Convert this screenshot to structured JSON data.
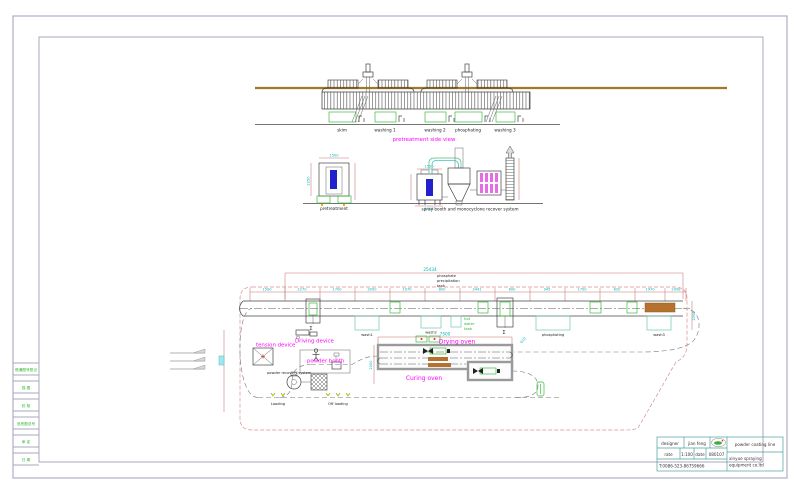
{
  "margin_strip": {
    "items": [
      "借通图号登记",
      "描 图",
      "校 核",
      "旧底图总号",
      "审 定",
      "日 期"
    ]
  },
  "side_view": {
    "caption": "pretreatment side view",
    "tank_labels": [
      "skim",
      "washing 1",
      "washing 2",
      "phosphating",
      "washing 3"
    ]
  },
  "elevation": {
    "left_caption": "pretreatment",
    "right_caption": "spray booth and monocyclone recover system",
    "dim_left_v": "2250",
    "dim_left_h": "1500",
    "dim_booth_h": "1500",
    "dim_booth_base": "1008"
  },
  "plan": {
    "overall_dim": "25434",
    "oven_dim": "7500",
    "right_dim": "2008",
    "slant_dim": "610",
    "oven_side_dim": "2000",
    "segment_dims": [
      "1500",
      "2270",
      "1700",
      "3000",
      "1970",
      "800",
      "3441",
      "600",
      "945",
      "1700",
      "620",
      "1970",
      "2008"
    ],
    "station_sigma": "Σ",
    "labels": {
      "phosphate_tank_l1": "phosphate",
      "phosphate_tank_l2": "precipitation",
      "phosphate_tank_l3": "tank",
      "hot_water_l1": "hot",
      "hot_water_l2": "water",
      "hot_water_l3": "tank",
      "wash1": "wash1",
      "wash2": "wash2",
      "phosphating": "phosphating",
      "wash3": "wash3",
      "driving": "Driving device",
      "tension": "tension device",
      "powder_booth": "powder booth",
      "recovery": "powder recovery system",
      "drying": "Drying oven",
      "curing": "Curing oven",
      "loading": "Loading",
      "offloading": "Off loading"
    }
  },
  "title_block": {
    "designer_label": "designer",
    "designer_value": "jian feng",
    "rate_label": "rate",
    "rate_value": "1:100",
    "date_label": "date",
    "date_value": "080107",
    "phone": "T:0086-523-86759666",
    "project": "powder coating line",
    "company_l1": "xinyue spraying",
    "company_l2": "equipment co.ltd"
  },
  "colors": {
    "magenta": "#ff00ff",
    "dim_red": "#cc7070",
    "cyan_dim": "#00b7b7",
    "green": "#2eb82e",
    "tank_fill": "#b8eeb8",
    "brown_rail": "#a07828",
    "brown_bar": "#b5722f",
    "blue_part": "#2222cc",
    "filter_magenta": "#e86ae8"
  }
}
